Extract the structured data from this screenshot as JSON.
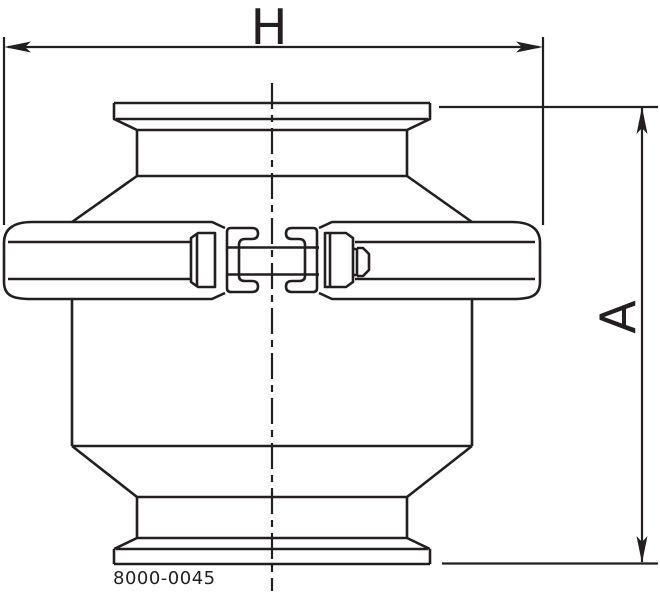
{
  "drawing": {
    "type": "technical-dimension-drawing",
    "part_number": "8000-0045",
    "dimensions": {
      "horizontal": {
        "label": "H"
      },
      "vertical": {
        "label": "A"
      }
    },
    "colors": {
      "line": "#231f20",
      "background": "#ffffff"
    }
  }
}
